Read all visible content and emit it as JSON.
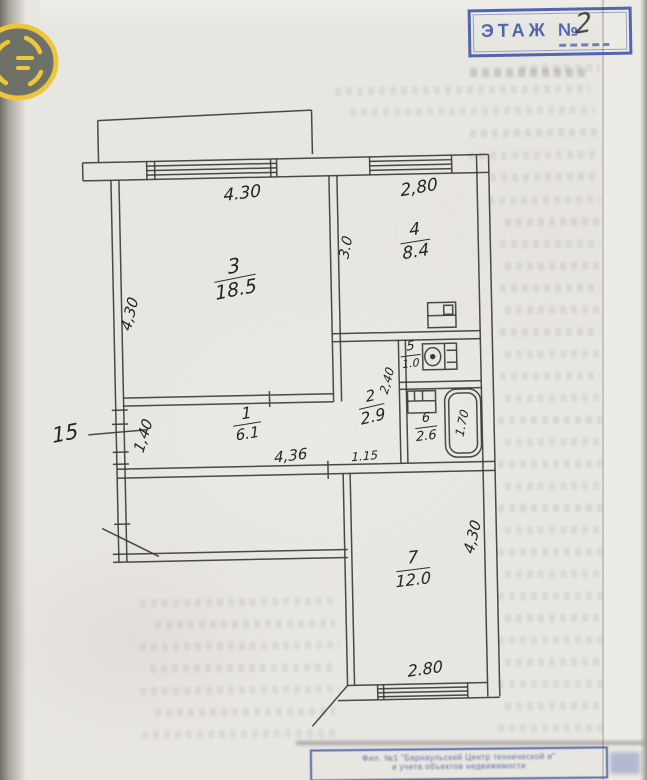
{
  "floor_stamp": {
    "label": "ЭТАЖ №",
    "value": "2"
  },
  "apartment_no": "15",
  "rooms": [
    {
      "number": "1",
      "area": "6.1"
    },
    {
      "number": "2",
      "area": "2.9"
    },
    {
      "number": "3",
      "area": "18.5"
    },
    {
      "number": "4",
      "area": "8.4"
    },
    {
      "number": "5",
      "area": "1.0"
    },
    {
      "number": "6",
      "area": "2.6"
    },
    {
      "number": "7",
      "area": "12.0"
    }
  ],
  "dims": {
    "top_left": "4.30",
    "top_right": "2,80",
    "room4_height": "3.0",
    "room3_height": "4,30",
    "hall_width": "1,40",
    "hall_length": "4,36",
    "hall_segment": "1.15",
    "inner_hall_height": "2,40",
    "tub_length": "1.70",
    "room7_height": "4,30",
    "room7_width": "2.80"
  },
  "registry_stamp": {
    "line1": "Фил. №1 \"Барнаульский Центр технической и\"",
    "line2": "и учета объектов недвижимости"
  },
  "colors": {
    "stamp_blue": "#3b54a6",
    "ink": "#2e2c28",
    "paper": "#e8e6e0",
    "logo_yellow": "#eec63c"
  }
}
